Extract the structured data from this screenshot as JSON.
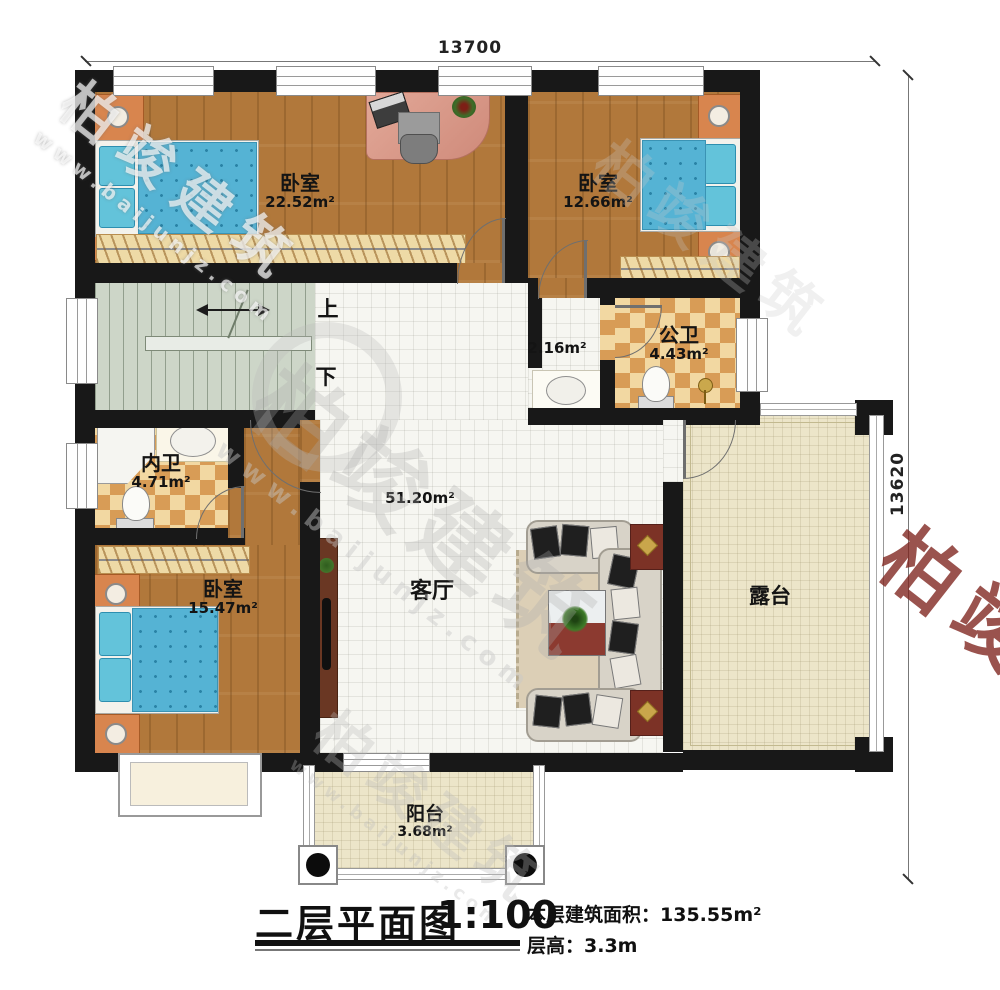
{
  "drawing": {
    "title": "二层平面图",
    "scale": "1:100",
    "area_label": "本层建筑面积：",
    "area_value": "135.55m²",
    "floor_height_label": "层高：",
    "floor_height_value": "3.3m"
  },
  "dimensions": {
    "top": "13700",
    "right": "13620"
  },
  "stairs": {
    "up": "上",
    "down": "下"
  },
  "rooms": {
    "bedroom_tl": {
      "name": "卧室",
      "area": "22.52m²"
    },
    "bedroom_tr": {
      "name": "卧室",
      "area": "12.66m²"
    },
    "public_bath": {
      "name": "公卫",
      "area": "4.43m²"
    },
    "vanity": {
      "area": "2.16m²"
    },
    "private_bath": {
      "name": "内卫",
      "area": "4.71m²"
    },
    "bedroom_bl": {
      "name": "卧室",
      "area": "15.47m²"
    },
    "living": {
      "name": "客厅",
      "area": "51.20m²"
    },
    "terrace": {
      "name": "露台"
    },
    "balcony": {
      "name": "阳台",
      "area": "3.68m²"
    }
  },
  "watermark": {
    "brand": "柏竣建筑",
    "url": "www.baijunjz.com"
  }
}
